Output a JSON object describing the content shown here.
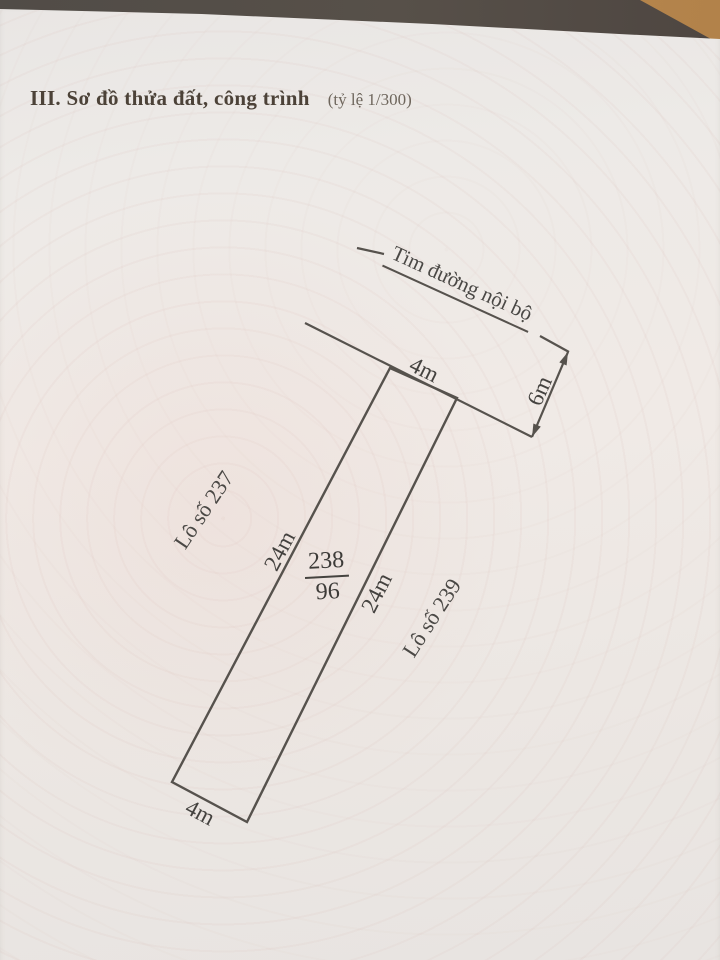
{
  "document": {
    "section_title": "III. Sơ đồ thửa đất, công trình",
    "scale_note": "(tỷ lệ 1/300)"
  },
  "parcel": {
    "number": "238",
    "area": "96",
    "road_centerline_label": "Tim đường nội bộ",
    "front_width": "4m",
    "back_width": "4m",
    "left_length": "24m",
    "right_length": "24m",
    "road_setback": "6m",
    "left_neighbor": "Lô số 237",
    "right_neighbor": "Lô số 239"
  },
  "colors": {
    "paper": "#ece8e5",
    "guilloche_tint": "#e9c6be",
    "ink": "#44423f",
    "line": "#56524d",
    "table_surface": "#55504a",
    "wood_corner": "#b9894f"
  }
}
